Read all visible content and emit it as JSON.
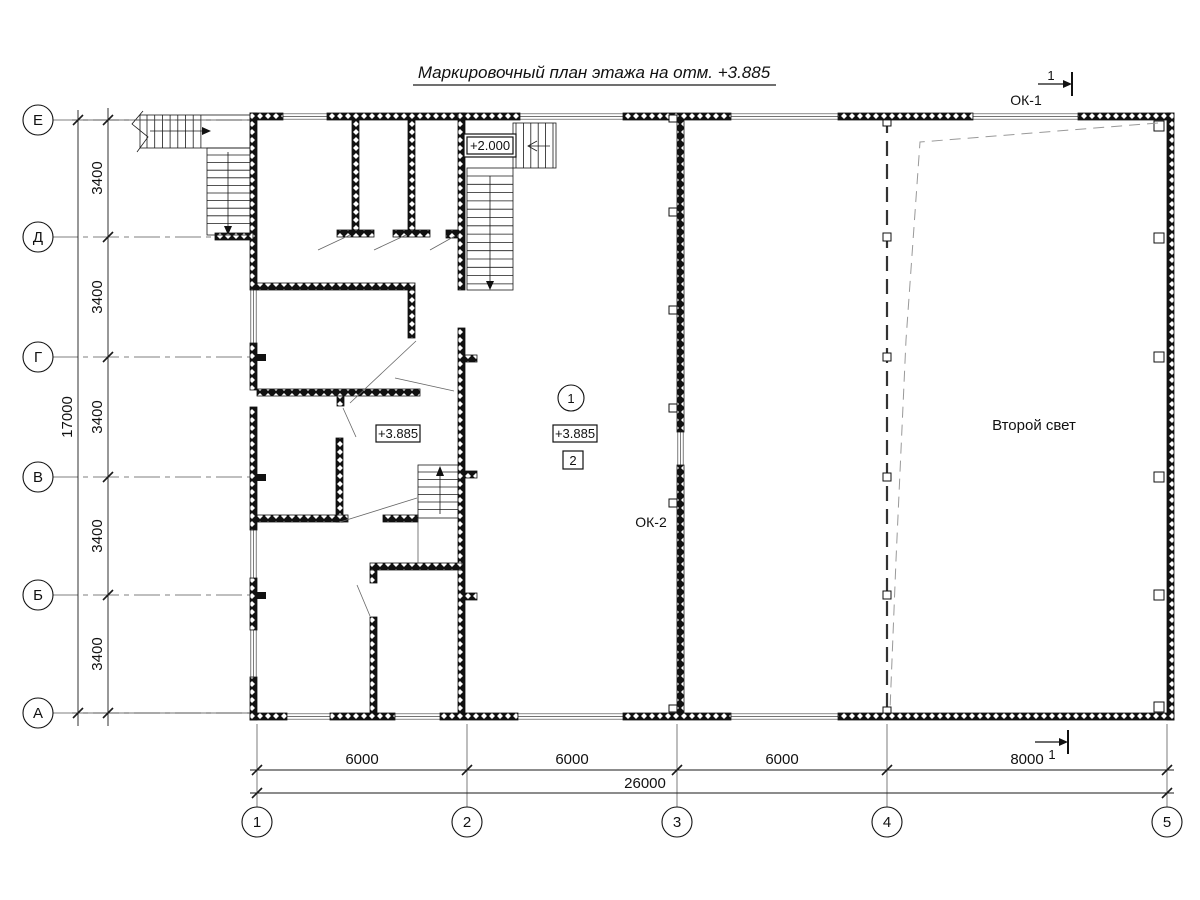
{
  "title": "Маркировочный план этажа на отм. +3.885",
  "axes": {
    "rows": [
      "Е",
      "Д",
      "Г",
      "В",
      "Б",
      "А"
    ],
    "cols": [
      "1",
      "2",
      "3",
      "4",
      "5"
    ]
  },
  "dims": {
    "left_segments": [
      "3400",
      "3400",
      "3400",
      "3400",
      "3400"
    ],
    "left_total": "17000",
    "bottom_segments": [
      "6000",
      "6000",
      "6000",
      "8000"
    ],
    "bottom_total": "26000"
  },
  "labels": {
    "ok1": "ОК-1",
    "ok2": "ОК-2",
    "second_light": "Второй свет",
    "elev_stair": "+2.000",
    "elev_left": "+3.885",
    "elev_hall": "+3.885",
    "room_circle": "1",
    "room_square": "2",
    "section_top": "1",
    "section_bottom": "1"
  },
  "colors": {
    "line": "#1a1a1a",
    "secondary_dash": "#999"
  }
}
